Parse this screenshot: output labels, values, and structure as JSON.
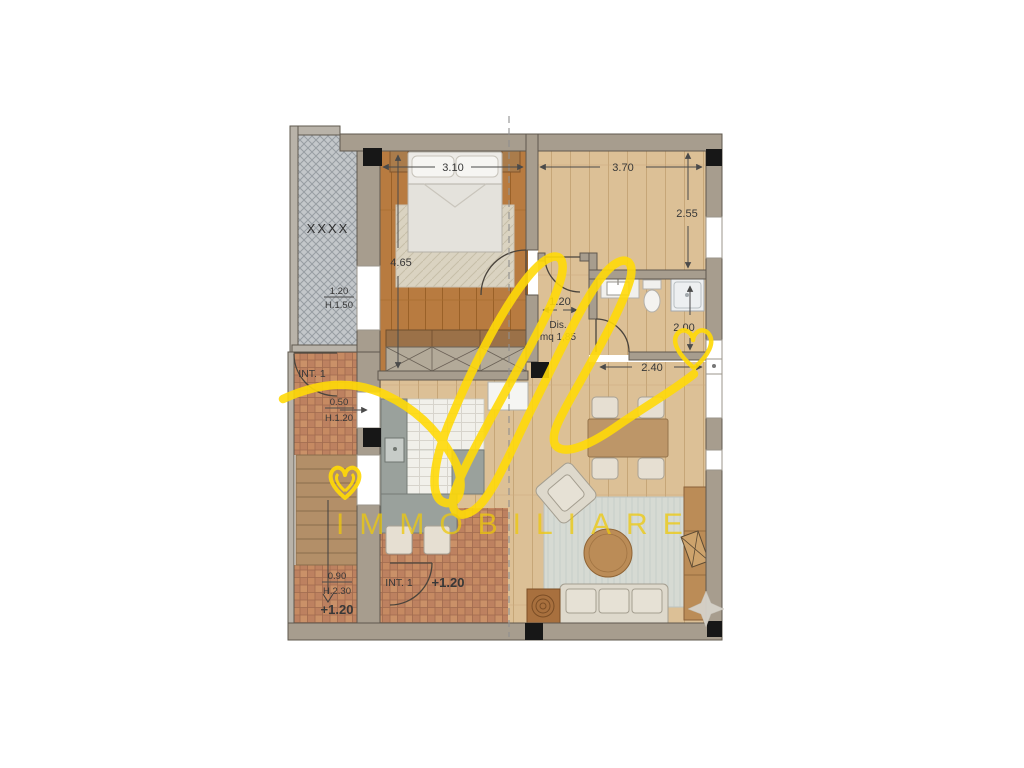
{
  "watermark": {
    "script_monogram": "fl",
    "brand_text": "IMMOBILIARE",
    "color": "#f5d309"
  },
  "plan": {
    "rooms": {
      "balcony_label": "XXXX",
      "hall_label": "Dis.",
      "hall_area": "mq 1,85"
    },
    "dimensions": {
      "bedroom_width": "3.10",
      "bedroom_depth": "4.65",
      "living_width": "3.70",
      "living_depth": "2.55",
      "hall_width": "1.20",
      "bath_height": "2.00",
      "bath_width": "2.40",
      "balcony_sill_width": "1.20",
      "balcony_sill_height": "H.1.50",
      "window_width": "0.50",
      "window_height": "H.1.20",
      "door_width": "0.90",
      "door_height": "H.2.30"
    },
    "labels": {
      "interior_upper": "INT. 1",
      "interior_lower": "INT. 1",
      "level_entry": "+1.20",
      "level_stair": "+1.20"
    },
    "colors": {
      "wall": "#a79d8e",
      "wood_dark": "#b87b40",
      "wood_light": "#dcc096",
      "terracotta": "#bd8160",
      "balcony_grid": "#c3c7ca"
    }
  }
}
